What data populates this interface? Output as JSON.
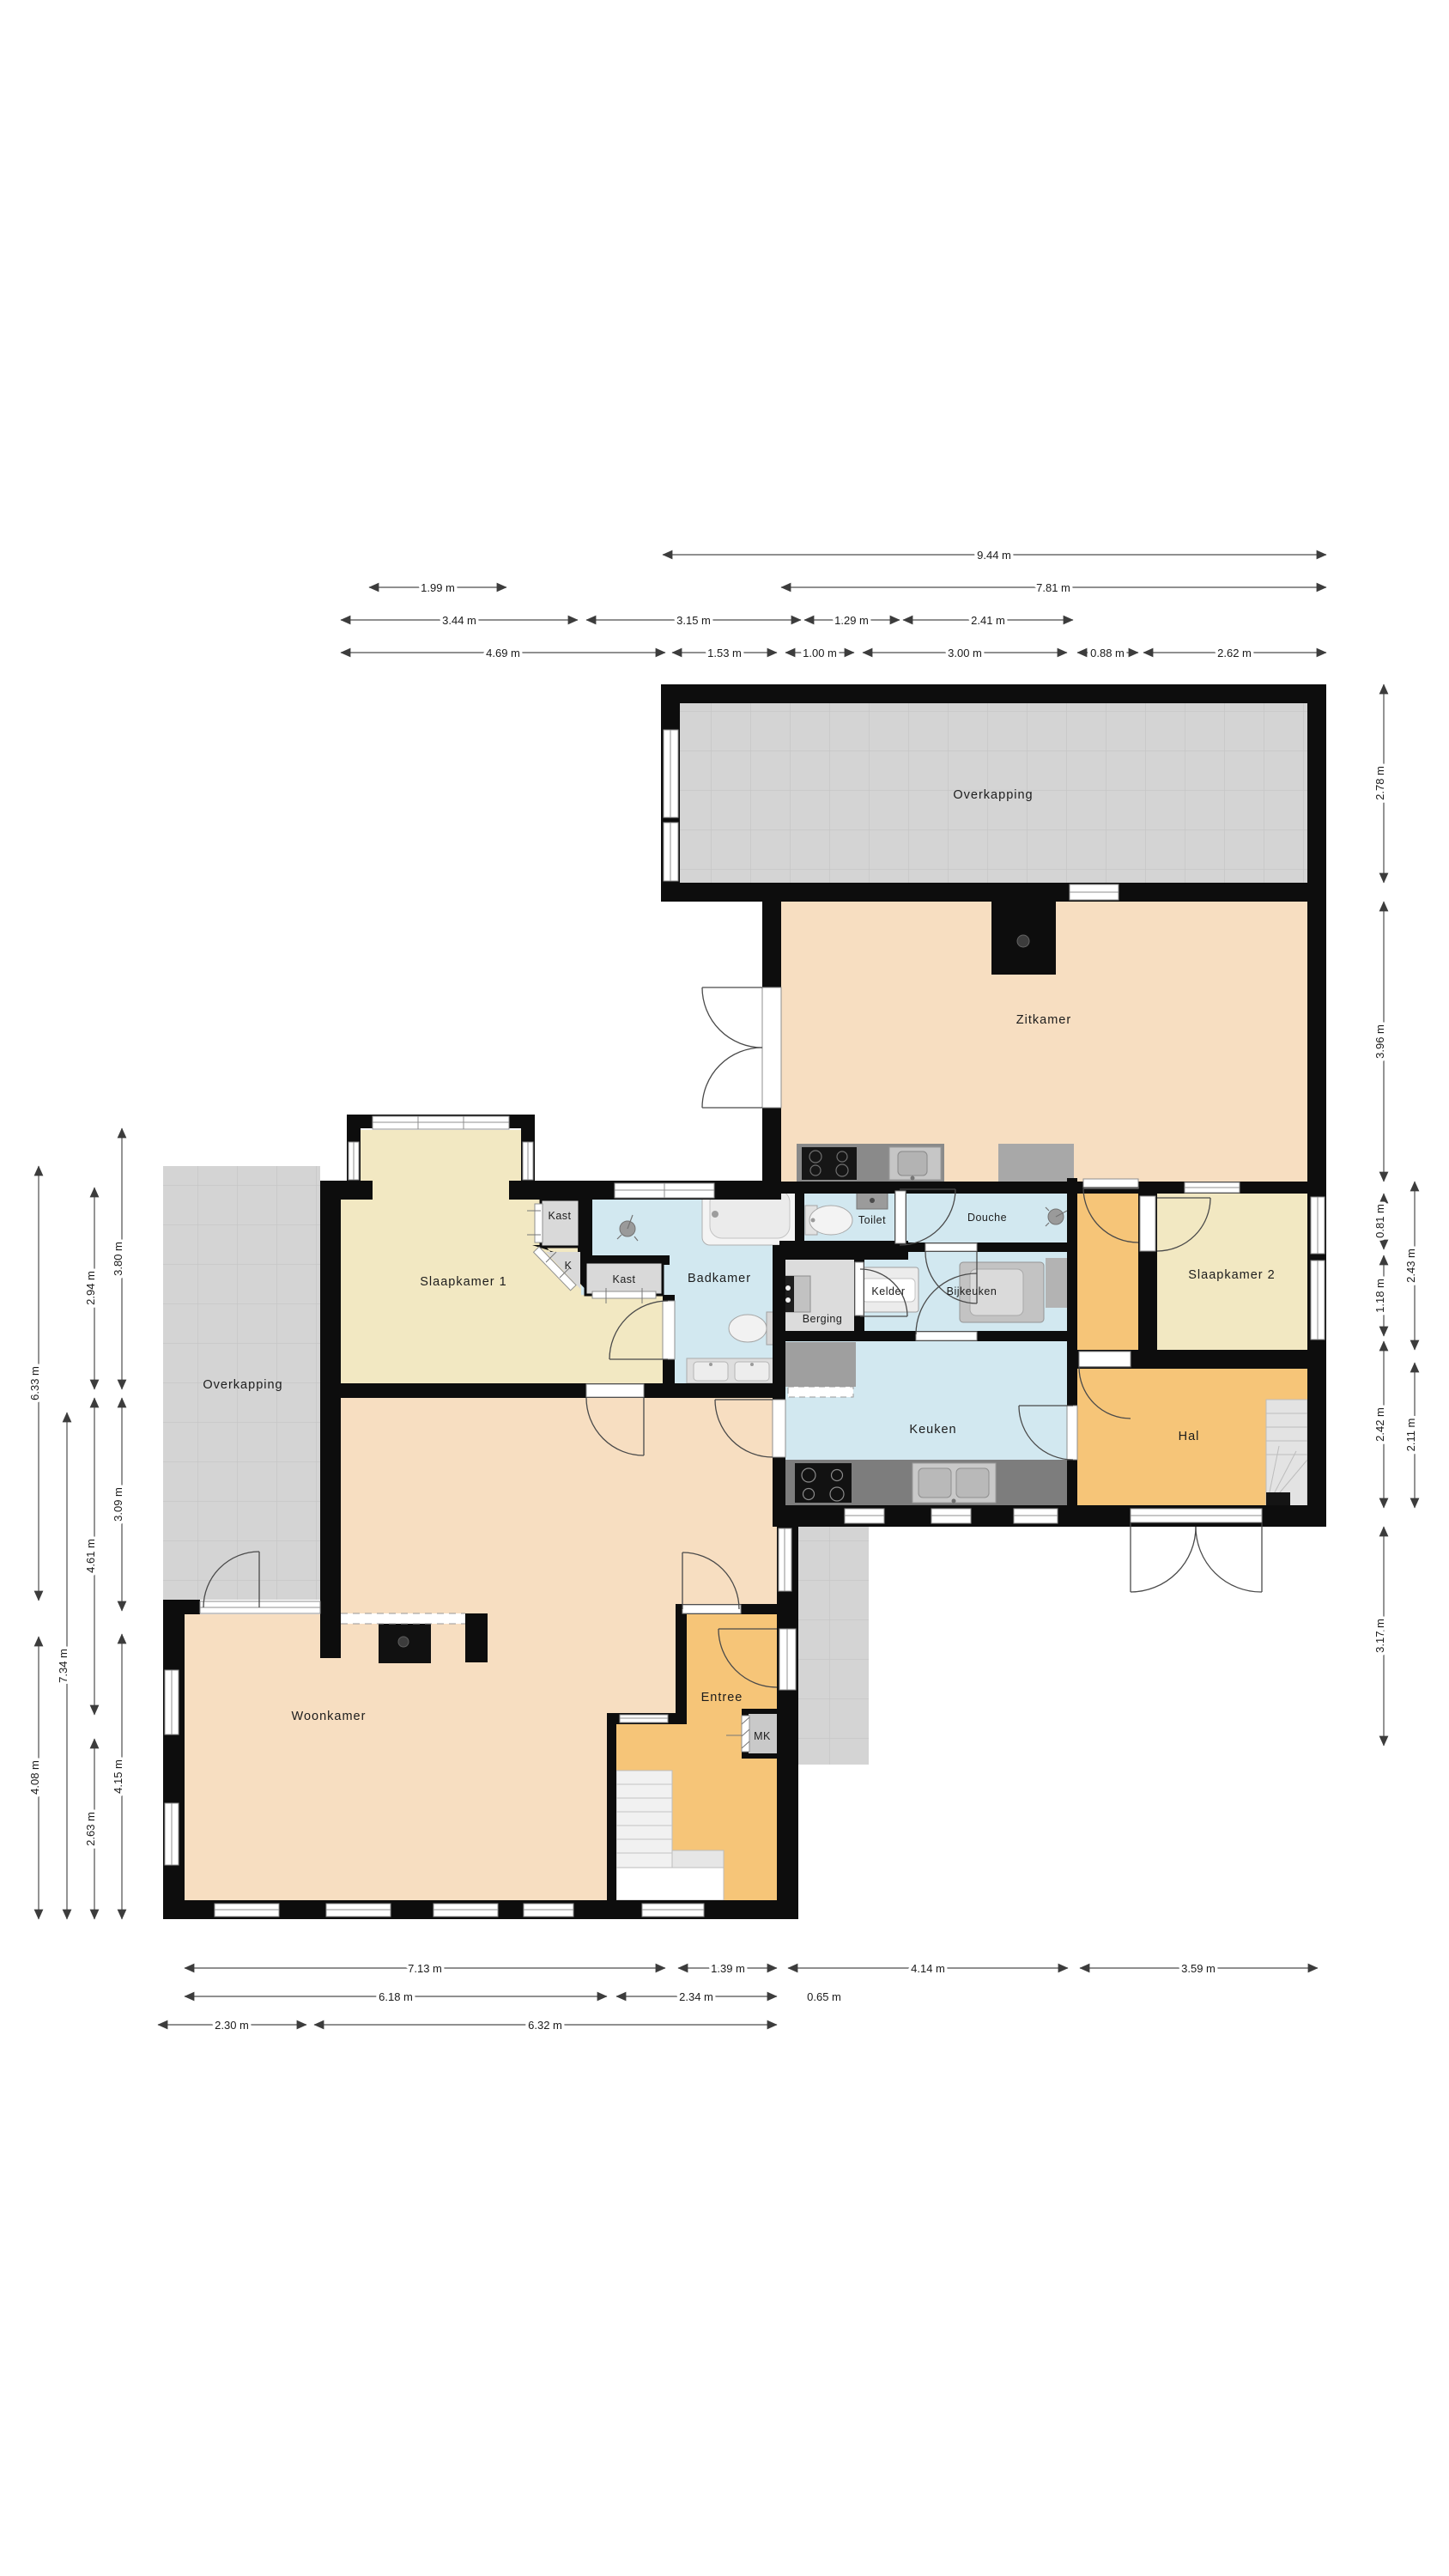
{
  "meta": {
    "type": "floorplan",
    "language": "nl"
  },
  "palette": {
    "wall": "#0d0d0d",
    "living": "#f7dec1",
    "bedroom": "#f2e8c2",
    "wet_room": "#d2e8f0",
    "hall": "#f6c578",
    "pavement": "#d4d4d4",
    "storage_gray": "#dcdcdc",
    "counter_dark": "#7d7d7d"
  },
  "rooms": {
    "overkapping_top": "Overkapping",
    "overkapping_left": "Overkapping",
    "zitkamer": "Zitkamer",
    "toilet": "Toilet",
    "douche": "Douche",
    "kelder": "Kelder",
    "bijkeuken": "Bijkeuken",
    "berging": "Berging",
    "slaapkamer1": "Slaapkamer 1",
    "slaapkamer2": "Slaapkamer 2",
    "kast1": "Kast",
    "kast_k": "K",
    "kast2": "Kast",
    "badkamer": "Badkamer",
    "keuken": "Keuken",
    "hal": "Hal",
    "woonkamer": "Woonkamer",
    "entree": "Entree",
    "mk": "MK"
  },
  "dims": {
    "top": [
      "9.44 m",
      "1.99 m",
      "7.81 m",
      "3.44 m",
      "3.15 m",
      "1.29 m",
      "2.41 m",
      "4.69 m",
      "1.53 m",
      "1.00 m",
      "3.00 m",
      "0.88 m",
      "2.62 m"
    ],
    "right": [
      "2.78 m",
      "3.96 m",
      "0.81 m",
      "1.18 m",
      "2.42 m",
      "2.43 m",
      "2.11 m",
      "3.17 m"
    ],
    "left": [
      "6.33 m",
      "4.08 m",
      "7.34 m",
      "2.94 m",
      "4.61 m",
      "2.63 m",
      "3.80 m",
      "3.09 m",
      "4.15 m"
    ],
    "bottom": [
      "7.13 m",
      "1.39 m",
      "4.14 m",
      "3.59 m",
      "6.18 m",
      "2.34 m",
      "0.65 m",
      "2.30 m",
      "6.32 m"
    ]
  }
}
